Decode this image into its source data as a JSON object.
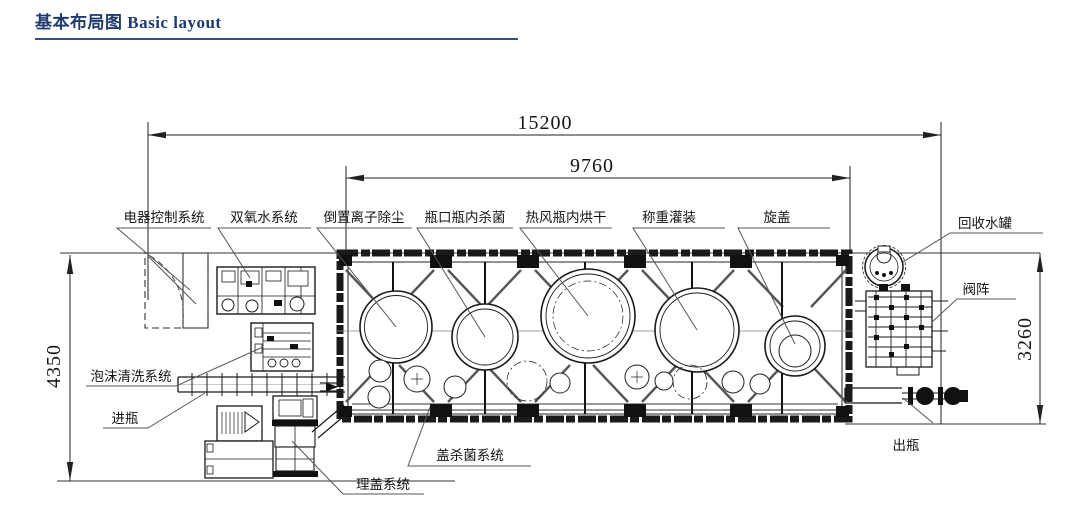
{
  "page": {
    "title": "基本布局图 Basic layout"
  },
  "dimensions": {
    "overall_length": "15200",
    "main_machine_length": "9760",
    "left_depth": "4350",
    "right_depth": "3260"
  },
  "stations": {
    "electrical_control": "电器控制系统",
    "hydrogen_peroxide": "双氧水系统",
    "ion_dust_removal": "倒置离子除尘",
    "bottle_sterilizing": "瓶口瓶内杀菌",
    "hot_air_drying": "热风瓶内烘干",
    "weigh_filling": "称重灌装",
    "capping": "旋盖",
    "recovery_tank": "回收水罐",
    "valve_array": "阀阵",
    "foam_cleaning": "泡沫清洗系统",
    "bottle_in": "进瓶",
    "bottle_out": "出瓶",
    "cap_sterilizing": "盖杀菌系统",
    "cap_arranging": "理盖系统"
  },
  "colors": {
    "title_accent": "#1e3a6e",
    "line": "#1a1a1a"
  }
}
